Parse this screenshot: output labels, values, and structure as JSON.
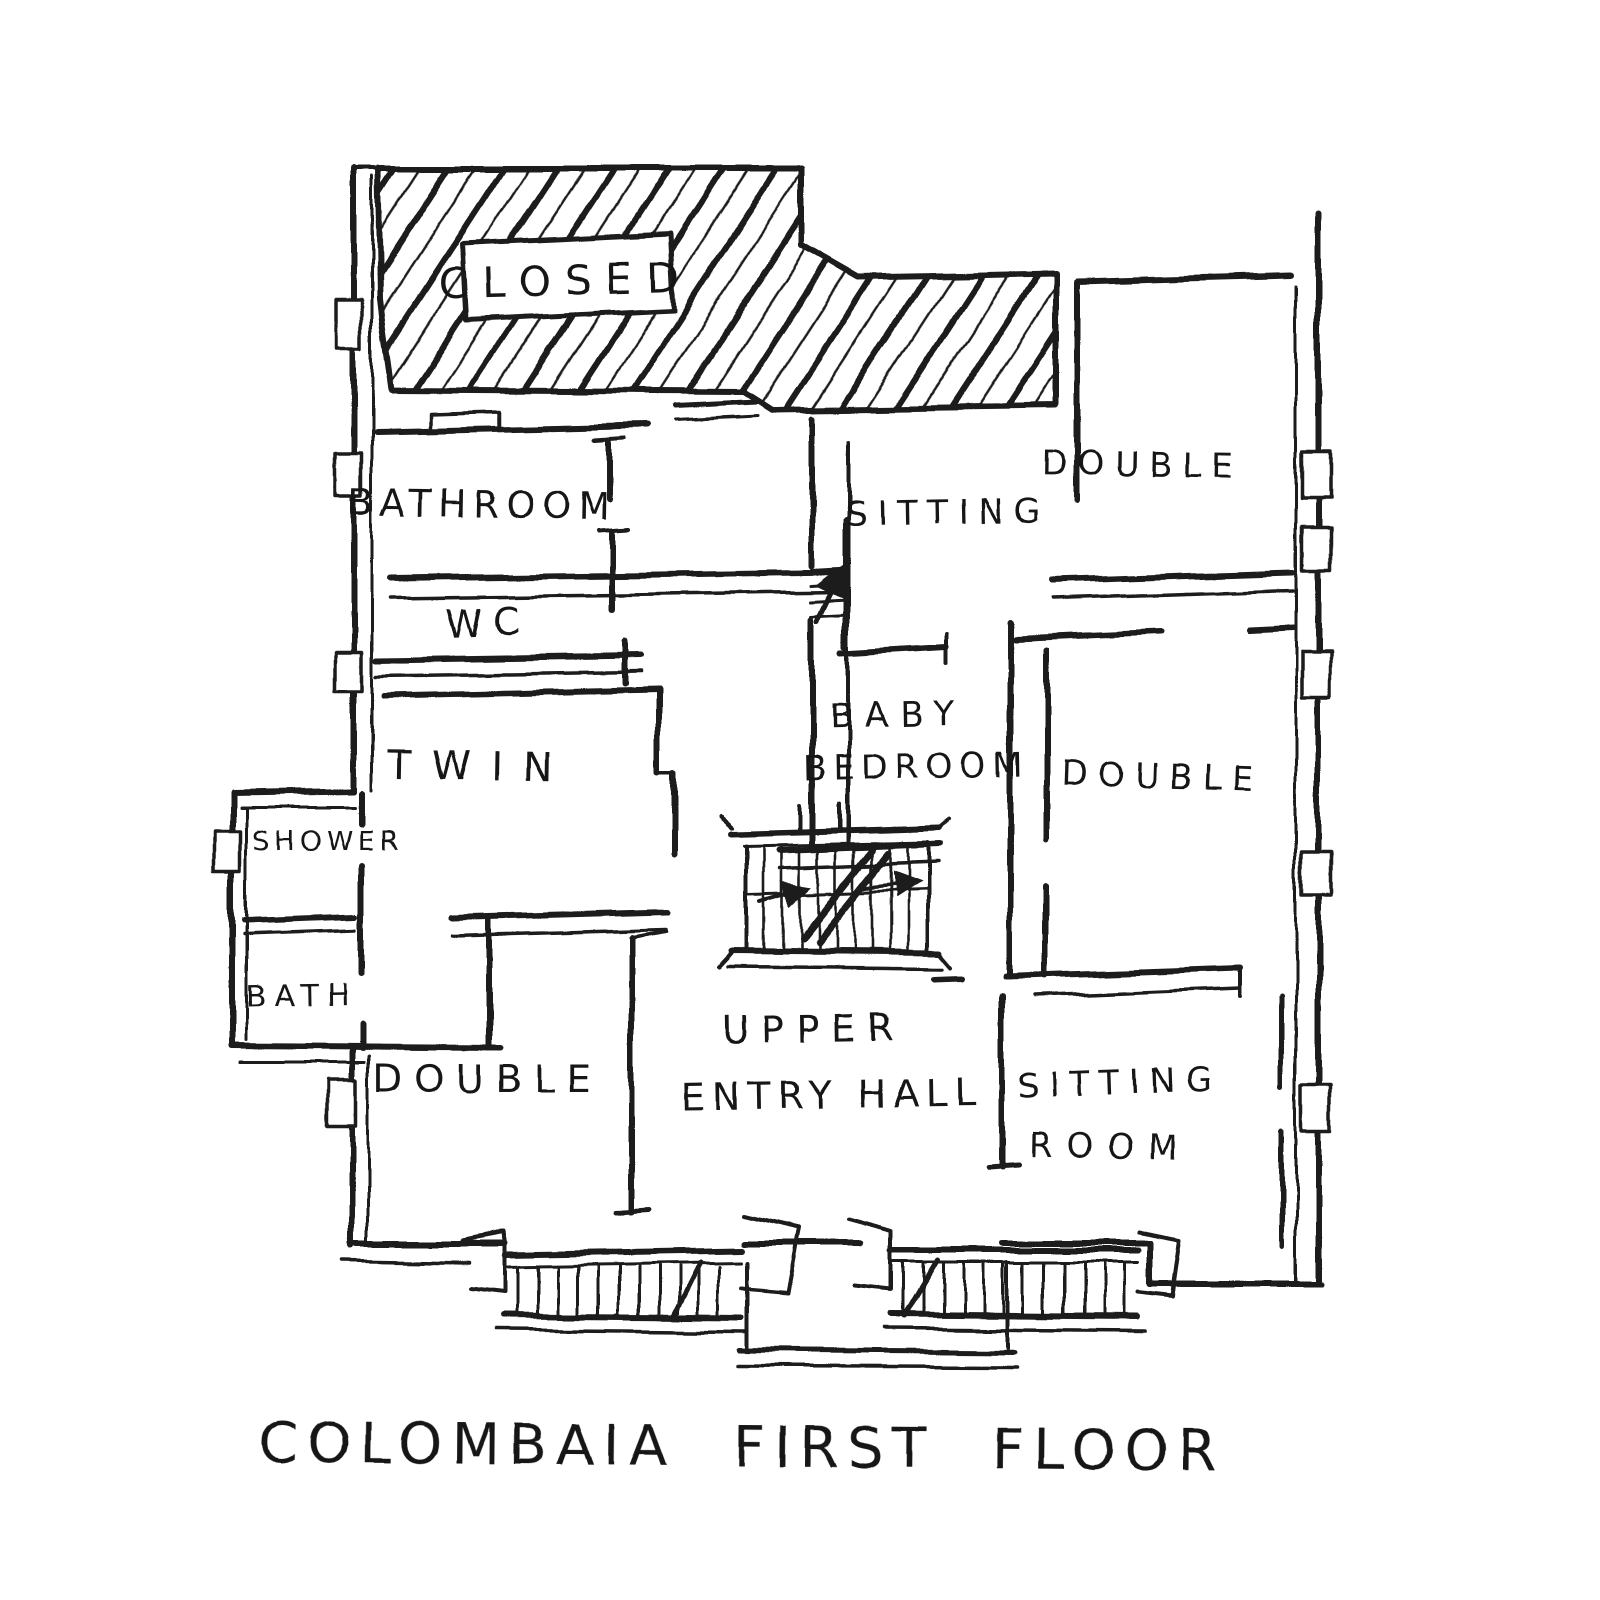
{
  "drawing_title": "COLOMBAIA FIRST FLOOR",
  "colors": {
    "ink": "#1b1b1b",
    "paper": "#ffffff"
  },
  "room_labels": {
    "closed": "CLOSED",
    "bathroom": "BATHROOM",
    "wc": "WC",
    "twin": "TWIN",
    "shower": "SHOWER",
    "bath": "BATH",
    "double_left": "DOUBLE",
    "sitting_top": "SITTING",
    "double_top_right": "DOUBLE",
    "baby_bedroom": {
      "line1": "BABY",
      "line2": "BEDROOM"
    },
    "double_right": "DOUBLE",
    "upper_entry_hall": {
      "line1": "UPPER",
      "line2": "ENTRY HALL"
    },
    "sitting_room": {
      "line1": "SITTING",
      "line2": "ROOM"
    }
  }
}
